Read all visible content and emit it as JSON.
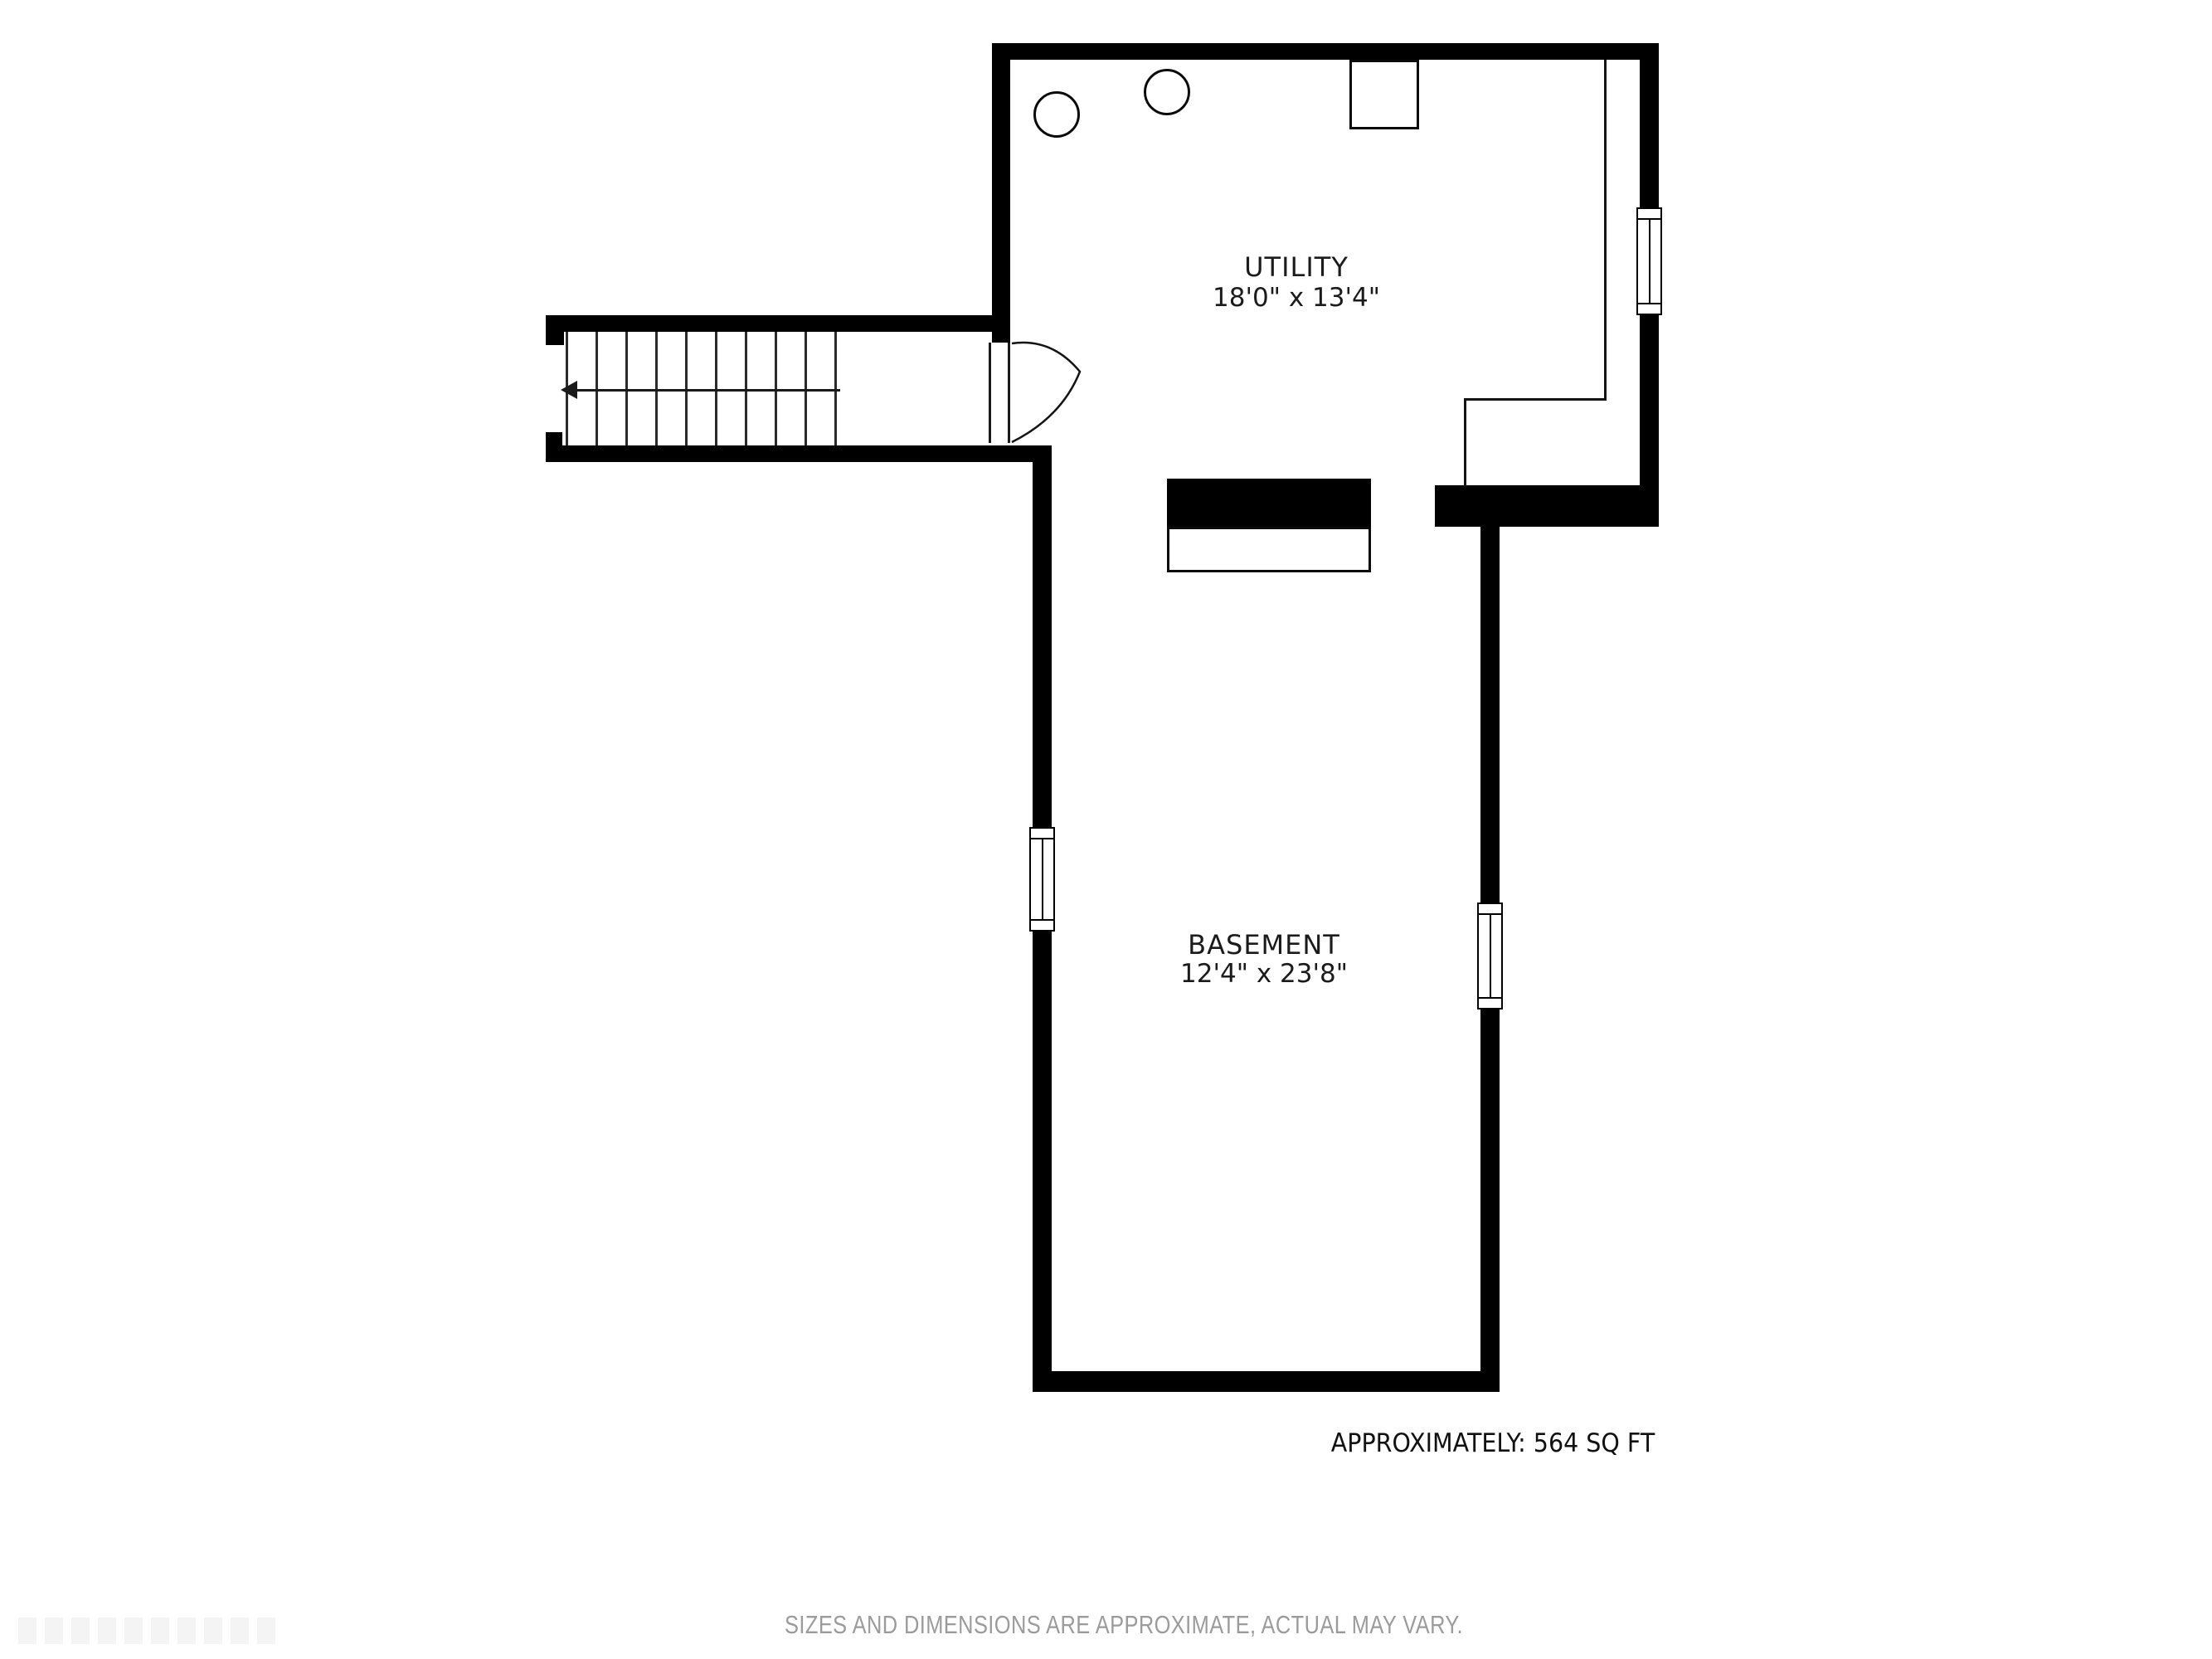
{
  "plan": {
    "title_context": "basement floor plan",
    "rooms": [
      {
        "name": "UTILITY",
        "dimensions": "18'0\" x 13'4\""
      },
      {
        "name": "BASEMENT",
        "dimensions": "12'4\" x 23'8\""
      }
    ],
    "area_text": "APPROXIMATELY: 564 SQ FT",
    "disclaimer": "SIZES AND DIMENSIONS ARE APPROXIMATE, ACTUAL MAY VARY.",
    "features": {
      "stairs": {
        "direction": "down-to-left",
        "tread_count": 10
      },
      "door": {
        "type": "swing-door",
        "location": "between stairs landing and utility room"
      },
      "windows": [
        {
          "location": "utility right wall"
        },
        {
          "location": "basement left wall"
        },
        {
          "location": "basement right wall"
        }
      ],
      "equipment": [
        {
          "shape": "circle",
          "location": "utility top-left"
        },
        {
          "shape": "circle",
          "location": "utility top-left"
        },
        {
          "shape": "square",
          "location": "utility top wall"
        },
        {
          "shape": "bench",
          "location": "between utility and basement"
        }
      ]
    },
    "colors": {
      "wall": "#000000",
      "background": "#ffffff",
      "label_text": "#1b1b1b",
      "disclaimer_text": "#9b9b9b"
    }
  }
}
